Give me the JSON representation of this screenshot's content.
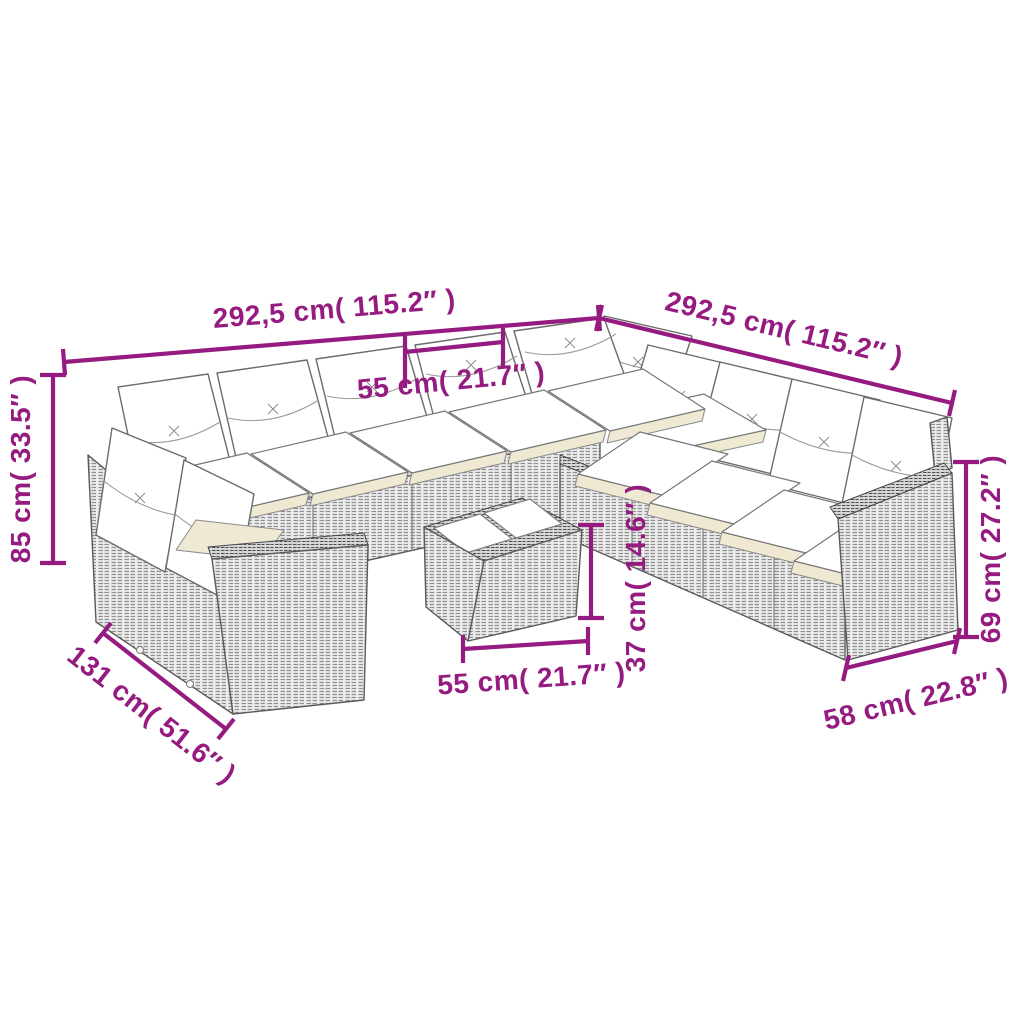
{
  "diagram": {
    "type": "product-dimension-line-drawing",
    "subject": "rattan garden lounge set with cushions and coffee table",
    "background": "#ffffff",
    "colors": {
      "annotation": "#951B81",
      "outline": "#5a5a5a",
      "rattan_fill": "#ededed",
      "rattan_stroke": "#8f8f8f",
      "rim_fill": "#d6d6d6",
      "cushion_fill": "#ffffff",
      "seat_shadow": "#efe8d2"
    },
    "dimensions": {
      "sofa_width_left": {
        "label": "292,5 cm( 115.2″ )"
      },
      "sofa_width_right": {
        "label": "292,5 cm( 115.2″ )"
      },
      "seat_width_top": {
        "label": "55 cm( 21.7″ )"
      },
      "total_height": {
        "label": "85 cm( 33.5″ )"
      },
      "chaise_depth": {
        "label": "131 cm( 51.6″ )"
      },
      "table_width": {
        "label": "55 cm( 21.7″ )"
      },
      "table_height": {
        "label": "37 cm( 14.6″ )"
      },
      "arm_height": {
        "label": "69 cm( 27.2″ )"
      },
      "arm_depth": {
        "label": "58 cm( 22.8″ )"
      }
    }
  }
}
